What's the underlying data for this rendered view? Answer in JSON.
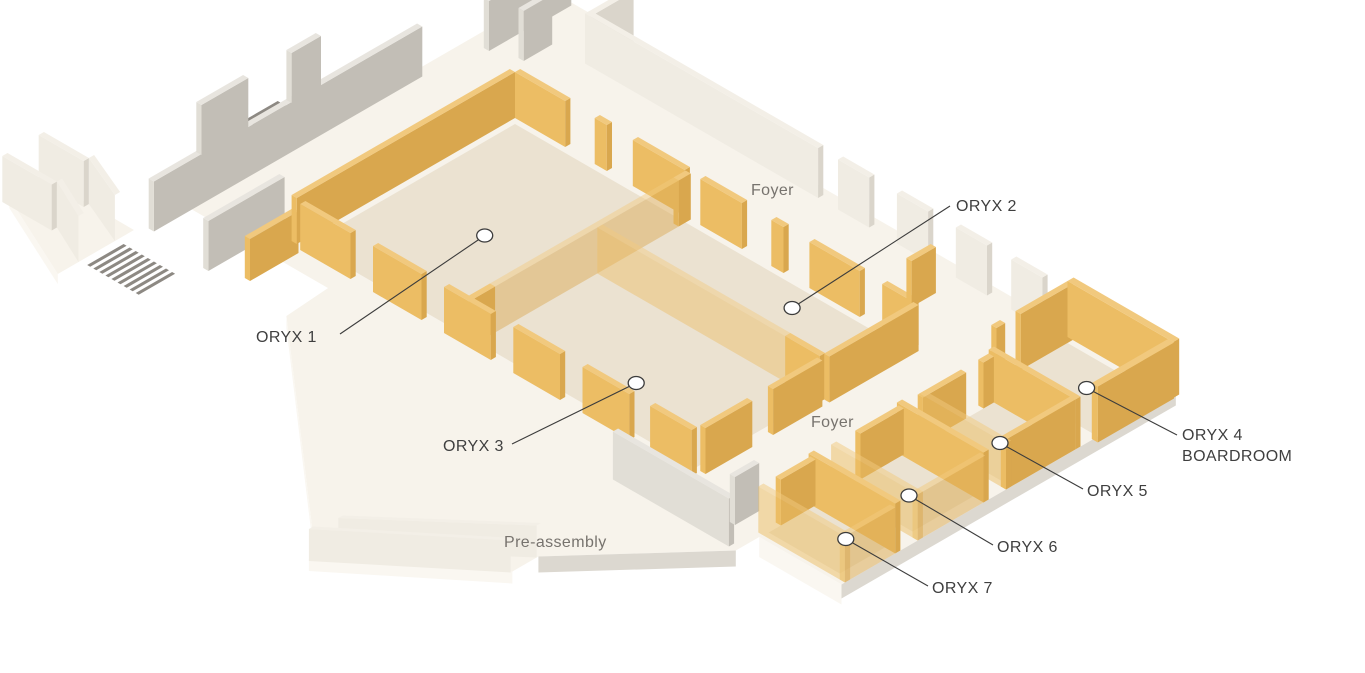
{
  "diagram": {
    "type": "isometric-floorplan",
    "rooms": [
      {
        "id": "oryx-1",
        "label": "ORYX 1"
      },
      {
        "id": "oryx-2",
        "label": "ORYX 2"
      },
      {
        "id": "oryx-3",
        "label": "ORYX 3"
      },
      {
        "id": "oryx-4",
        "label": "ORYX 4",
        "sublabel": "BOARDROOM"
      },
      {
        "id": "oryx-5",
        "label": "ORYX 5"
      },
      {
        "id": "oryx-6",
        "label": "ORYX 6"
      },
      {
        "id": "oryx-7",
        "label": "ORYX 7"
      }
    ],
    "areas": [
      {
        "id": "foyer-north",
        "label": "Foyer"
      },
      {
        "id": "foyer-east",
        "label": "Foyer"
      },
      {
        "id": "pre-assembly",
        "label": "Pre-assembly"
      }
    ]
  },
  "colors": {
    "background": "#FFFFFF",
    "slab": "#F7F3EB",
    "slab_edge_light": "#FAF7F1",
    "slab_edge_dark": "#DCD8D0",
    "room_floor": "#EBE2D1",
    "partition_top": "#F1C97E",
    "partition_light": "#ECBD64",
    "partition_dark": "#D9A74E",
    "wall_cream_top": "#F3EFE7",
    "wall_cream_light": "#F0ECE3",
    "wall_cream_dark": "#DAD5CB",
    "wall_gray_top": "#E8E5DF",
    "wall_gray_light": "#E1DED6",
    "wall_gray_dark": "#C2BEB6",
    "stairs": "#8D8983",
    "callout_line": "#3C3C3C",
    "marker_fill": "#FFFFFF",
    "room_label_text": "#3F3F3F",
    "area_label_text": "#77736E"
  }
}
